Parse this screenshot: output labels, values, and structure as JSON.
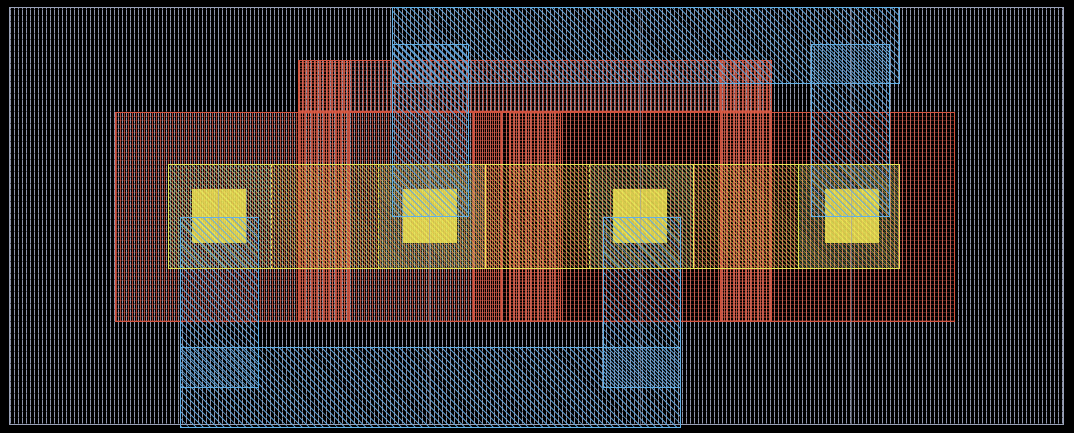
{
  "canvas": {
    "width": 1074,
    "height": 433,
    "background": "#000000"
  },
  "palette": {
    "substrate_gray": "#9aa2b8",
    "implant_red": "#d2523e",
    "metal_blue": "#63b0e6",
    "active_yellow": "#eae556",
    "contact_yellow": "#f2ee58",
    "contact_metal_overlap_teal": "#7dd6be",
    "grid_gray": "#98a0b6"
  },
  "grid": {
    "vertical_x": [
      218,
      429,
      640,
      851
    ],
    "y1": 7,
    "y2": 425
  },
  "shapes": [
    {
      "name": "substrate-well",
      "cls": "substrate",
      "x": 9,
      "y": 7,
      "w": 1055,
      "h": 418
    },
    {
      "name": "implant-top-band",
      "cls": "red",
      "x": 298,
      "y": 60,
      "w": 474,
      "h": 52
    },
    {
      "name": "implant-left",
      "cls": "red",
      "x": 115,
      "y": 112,
      "w": 387,
      "h": 210
    },
    {
      "name": "implant-right",
      "cls": "red",
      "x": 473,
      "y": 112,
      "w": 482,
      "h": 210
    },
    {
      "name": "poly-gate-1",
      "cls": "red-dense",
      "x": 298,
      "y": 60,
      "w": 52,
      "h": 262
    },
    {
      "name": "poly-gate-2",
      "cls": "red-dense",
      "x": 509,
      "y": 112,
      "w": 52,
      "h": 210
    },
    {
      "name": "poly-gate-3",
      "cls": "red-dense",
      "x": 720,
      "y": 60,
      "w": 52,
      "h": 262
    },
    {
      "name": "active-band",
      "cls": "band-fill",
      "x": 168,
      "y": 164,
      "w": 732,
      "h": 105
    },
    {
      "name": "active-tint-1",
      "cls": "tint",
      "x": 168,
      "y": 164,
      "w": 103,
      "h": 105
    },
    {
      "name": "active-tint-2",
      "cls": "tint",
      "x": 378,
      "y": 164,
      "w": 107,
      "h": 105
    },
    {
      "name": "active-tint-3",
      "cls": "tint",
      "x": 589,
      "y": 164,
      "w": 104,
      "h": 105
    },
    {
      "name": "active-tint-4",
      "cls": "tint",
      "x": 798,
      "y": 164,
      "w": 102,
      "h": 105
    },
    {
      "name": "contact-1",
      "cls": "contact",
      "x": 192,
      "y": 189,
      "w": 54,
      "h": 54
    },
    {
      "name": "contact-2",
      "cls": "contact",
      "x": 403,
      "y": 189,
      "w": 54,
      "h": 54
    },
    {
      "name": "contact-3",
      "cls": "contact",
      "x": 613,
      "y": 189,
      "w": 54,
      "h": 54
    },
    {
      "name": "contact-4",
      "cls": "contact",
      "x": 825,
      "y": 189,
      "w": 54,
      "h": 54
    },
    {
      "name": "metal-rail-top",
      "cls": "blue",
      "x": 392,
      "y": 7,
      "w": 508,
      "h": 77
    },
    {
      "name": "metal-strip-contact-2",
      "cls": "blue",
      "x": 392,
      "y": 44,
      "w": 77,
      "h": 173
    },
    {
      "name": "metal-strip-contact-4",
      "cls": "blue",
      "x": 811,
      "y": 44,
      "w": 79,
      "h": 173
    },
    {
      "name": "metal-strip-contact-1",
      "cls": "blue",
      "x": 180,
      "y": 217,
      "w": 79,
      "h": 171
    },
    {
      "name": "metal-strip-contact-3",
      "cls": "blue",
      "x": 603,
      "y": 217,
      "w": 78,
      "h": 171
    },
    {
      "name": "metal-rail-bottom",
      "cls": "blue",
      "x": 180,
      "y": 347,
      "w": 501,
      "h": 81
    },
    {
      "name": "active-band-outline",
      "cls": "band-border",
      "x": 168,
      "y": 164,
      "w": 732,
      "h": 105
    }
  ],
  "band_dividers": [
    {
      "x": 271,
      "style": "dashed"
    },
    {
      "x": 378,
      "style": "dashed"
    },
    {
      "x": 485,
      "style": "solid"
    },
    {
      "x": 589,
      "style": "dashed"
    },
    {
      "x": 693,
      "style": "solid"
    },
    {
      "x": 798,
      "style": "solid"
    }
  ],
  "band_divider_span": {
    "y": 164,
    "h": 105
  }
}
